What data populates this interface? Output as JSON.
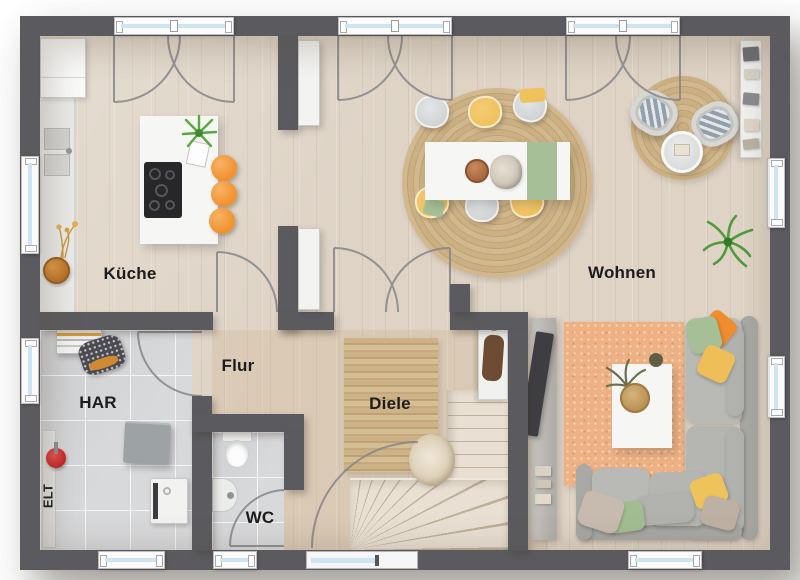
{
  "labels": {
    "kueche": "Küche",
    "wohnen": "Wohnen",
    "flur": "Flur",
    "diele": "Diele",
    "har": "HAR",
    "wc": "WC",
    "elt": "ELT"
  },
  "colors": {
    "wall": "#5b5b5f",
    "wood_floor": "#ded3c5",
    "warm_floor_tint": "rgba(200,163,120,0.20)",
    "tile_floor": "#d8d9db",
    "stairs_wood": "#e9e0d3",
    "stool_orange": "#f0922f",
    "chair_yellow": "#f0c25e",
    "textile_green": "#a7bf97",
    "rug_peach": "#eeb184",
    "sofa_gray": "#b9b9b5",
    "window_glass": "#cfe4f2",
    "door_arc": "#85858a",
    "label_text": "#1c1c1c"
  }
}
